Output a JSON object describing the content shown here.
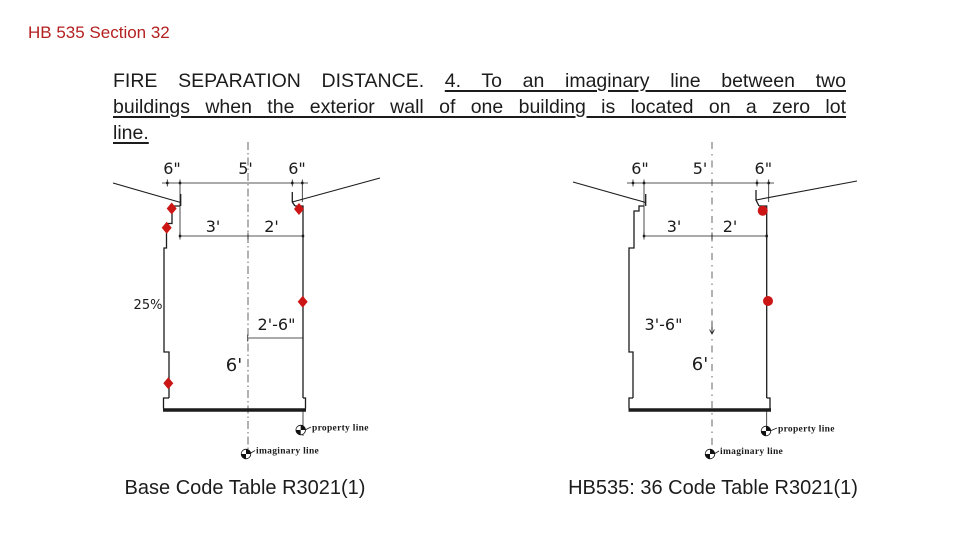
{
  "slide": {
    "title": "HB 535 Section 32",
    "body": {
      "line1_normal": "FIRE SEPARATION DISTANCE.",
      "line1_underlined": "4. To an imaginary line between two",
      "line2_underlined": "buildings when the exterior wall of one building is located on a zero lot",
      "line3_underlined": "line."
    },
    "captions": {
      "left": "Base Code Table R3021(1)",
      "right": "HB535: 36 Code Table R3021(1)"
    },
    "colors": {
      "title_red": "#b42020",
      "marker_red": "#cc1515",
      "line_black": "#1c1c1c"
    }
  },
  "diagram_left": {
    "dims": {
      "eave_left": "6\"",
      "span": "5'",
      "eave_right": "6\"",
      "offset_left": "3'",
      "offset_right": "2'",
      "slope": "25%",
      "setback": "2'-6\"",
      "total": "6'"
    },
    "labels": {
      "property_line": "property line",
      "imaginary_line": "imaginary line"
    }
  },
  "diagram_right": {
    "dims": {
      "eave_left": "6\"",
      "span": "5'",
      "eave_right": "6\"",
      "offset_left": "3'",
      "offset_right": "2'",
      "setback": "3'-6\"",
      "total": "6'"
    },
    "labels": {
      "property_line": "property line",
      "imaginary_line": "imaginary line"
    }
  }
}
